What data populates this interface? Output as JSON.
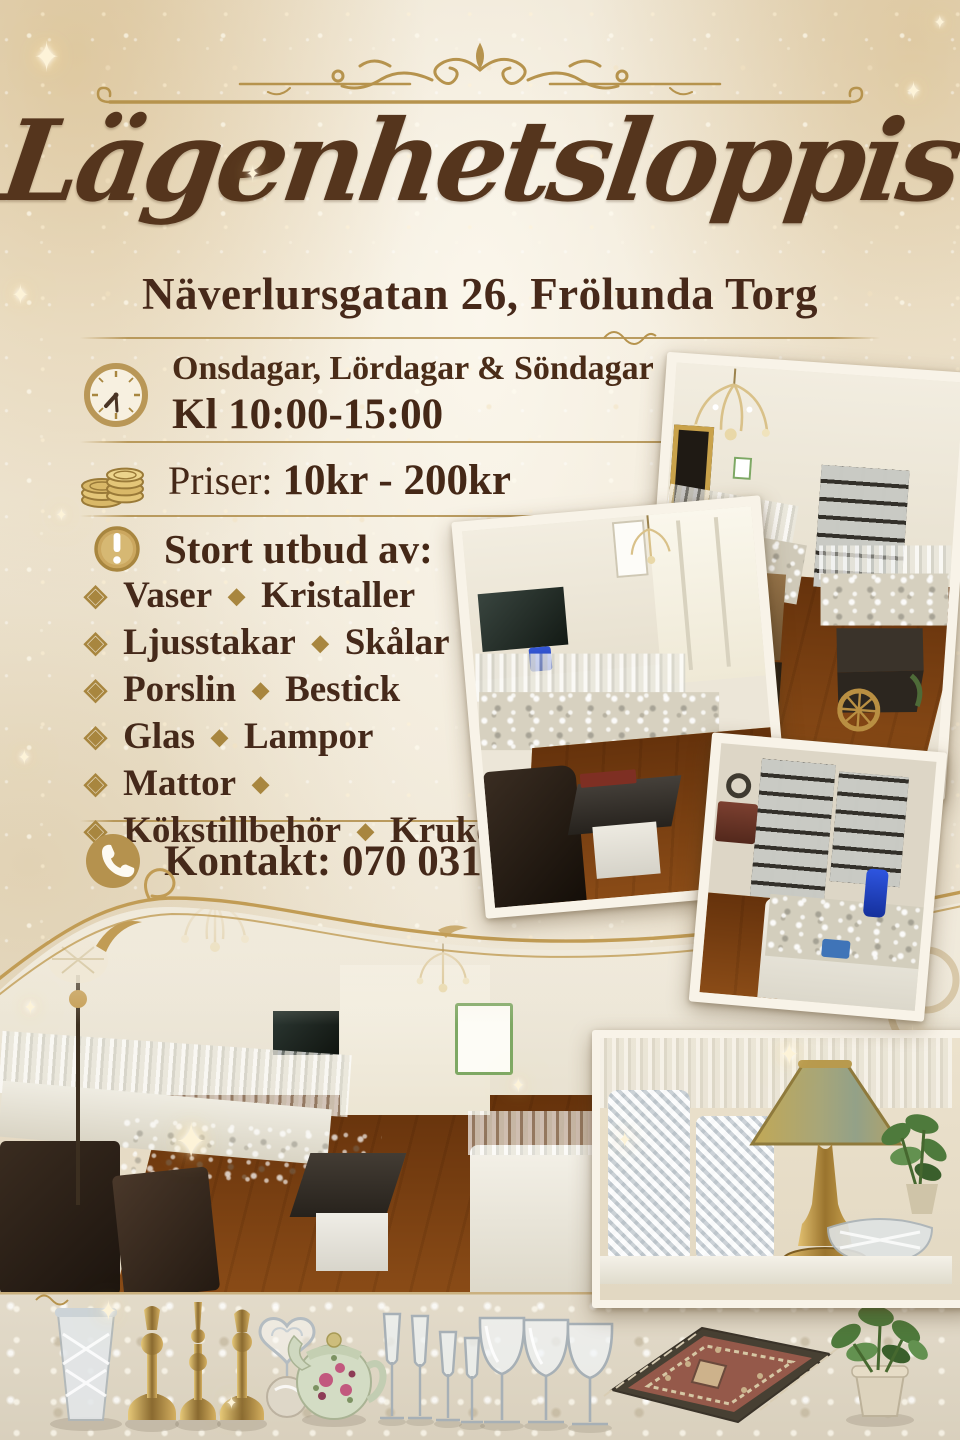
{
  "poster": {
    "title": "Lägenhetsloppis",
    "address": "Näverlursgatan 26, Frölunda Torg",
    "schedule": {
      "days": "Onsdagar, Lördagar & Söndagar",
      "hours": "Kl 10:00-15:00"
    },
    "prices": {
      "label": "Priser:",
      "range": "10kr - 200kr"
    },
    "offer": {
      "heading": "Stort utbud av:",
      "items": [
        {
          "first": "Vaser",
          "second": "Kristaller"
        },
        {
          "first": "Ljusstakar",
          "second": "Skålar"
        },
        {
          "first": "Porslin",
          "second": "Bestick"
        },
        {
          "first": "Glas",
          "second": "Lampor"
        },
        {
          "first": "Mattor",
          "second": ""
        },
        {
          "first": "Kökstillbehör",
          "second": "Krukor"
        }
      ]
    },
    "contact": {
      "label": "Kontakt:",
      "phone": "070 031 83 46"
    }
  },
  "icons": {
    "sparkle": "✦",
    "bullet": "◈",
    "separator": "◆",
    "names": [
      "clock-icon",
      "coins-icon",
      "alert-icon",
      "phone-icon",
      "diamond-bullet-icon",
      "diamond-separator-icon",
      "sparkle-star-icon",
      "header-flourish-icon",
      "divider-ornament-icon"
    ]
  },
  "colors": {
    "background": "#ece3d0",
    "accent_gold": "#b6934d",
    "text_brown": "#45291a",
    "title_brown": "#55351d",
    "photo_border": "#f8f3e8"
  }
}
